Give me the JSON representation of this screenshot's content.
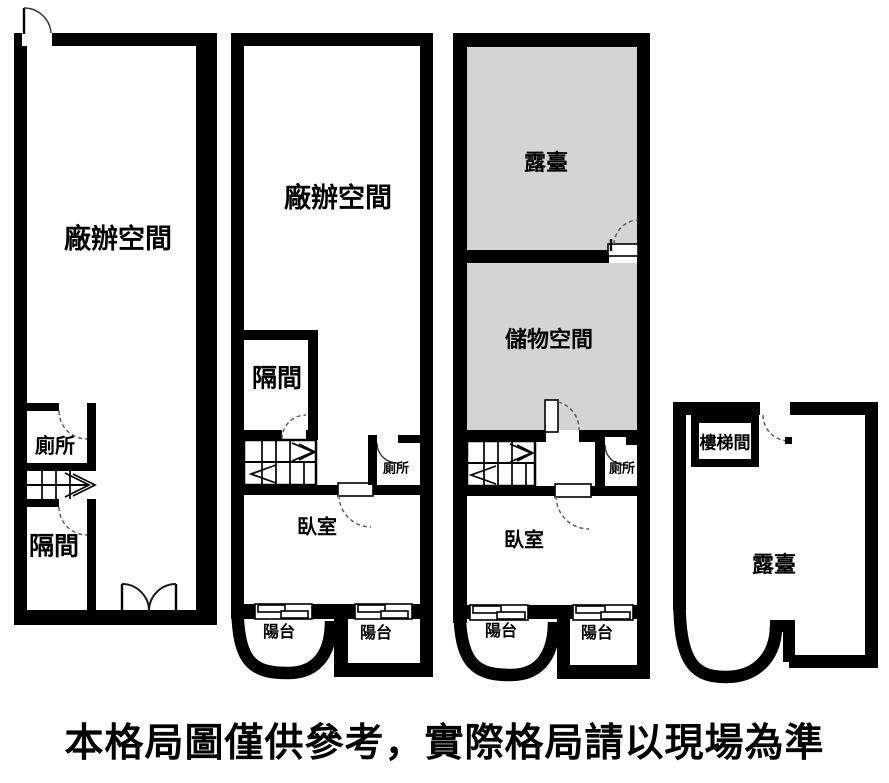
{
  "caption": "本格局圖僅供參考，實際格局請以現場為準",
  "colors": {
    "wall": "#000000",
    "background": "#ffffff",
    "terrace_fill": "#d4d4d4",
    "ink": "#000000"
  },
  "floors": [
    {
      "rooms": {
        "office": "廠辦空間",
        "toilet": "廁所",
        "partition": "隔間"
      }
    },
    {
      "rooms": {
        "office": "廠辦空間",
        "partition": "隔間",
        "toilet": "廁所",
        "bedroom": "臥室",
        "balcony_left": "陽台",
        "balcony_right": "陽台"
      }
    },
    {
      "rooms": {
        "terrace": "露臺",
        "storage": "儲物空間",
        "toilet": "廁所",
        "bedroom": "臥室",
        "balcony_left": "陽台",
        "balcony_right": "陽台"
      }
    },
    {
      "rooms": {
        "stairwell": "樓梯間",
        "terrace": "露臺"
      }
    }
  ]
}
